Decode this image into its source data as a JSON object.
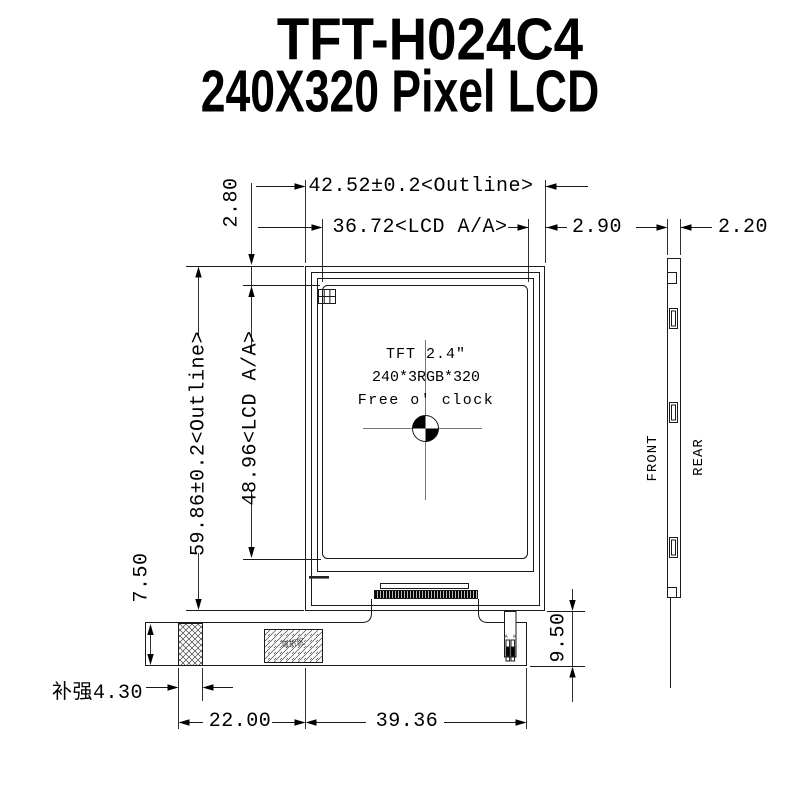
{
  "title": {
    "line1": "TFT-H024C4",
    "line2": "240X320 Pixel LCD"
  },
  "front_view": {
    "screen_label": {
      "line1": "TFT 2.4″",
      "line2": "240*3RGB*320",
      "line3": "Free o' clock"
    },
    "bend_zone_label": "弯折区",
    "backlight_pins_label": "A K"
  },
  "side_view": {
    "front_label": "FRONT",
    "rear_label": "REAR"
  },
  "dimensions": {
    "outline_width": "42.52±0.2<Outline>",
    "lcd_aa_width": "36.72<LCD A/A>",
    "aa_to_outline_right": "2.90",
    "side_thickness": "2.20",
    "outline_top_to_aa": "2.80",
    "outline_height": "59.86±0.2<Outline>",
    "lcd_aa_height": "48.96<LCD A/A>",
    "fpc_band_height": "7.50",
    "fpc_drop_height": "9.50",
    "stiffener_width": "补强4.30",
    "fpc_left_width": "22.00",
    "fpc_right_width": "39.36"
  },
  "colors": {
    "line": "#1a1a1a",
    "centerline": "#777777",
    "hatch": "#444444"
  }
}
